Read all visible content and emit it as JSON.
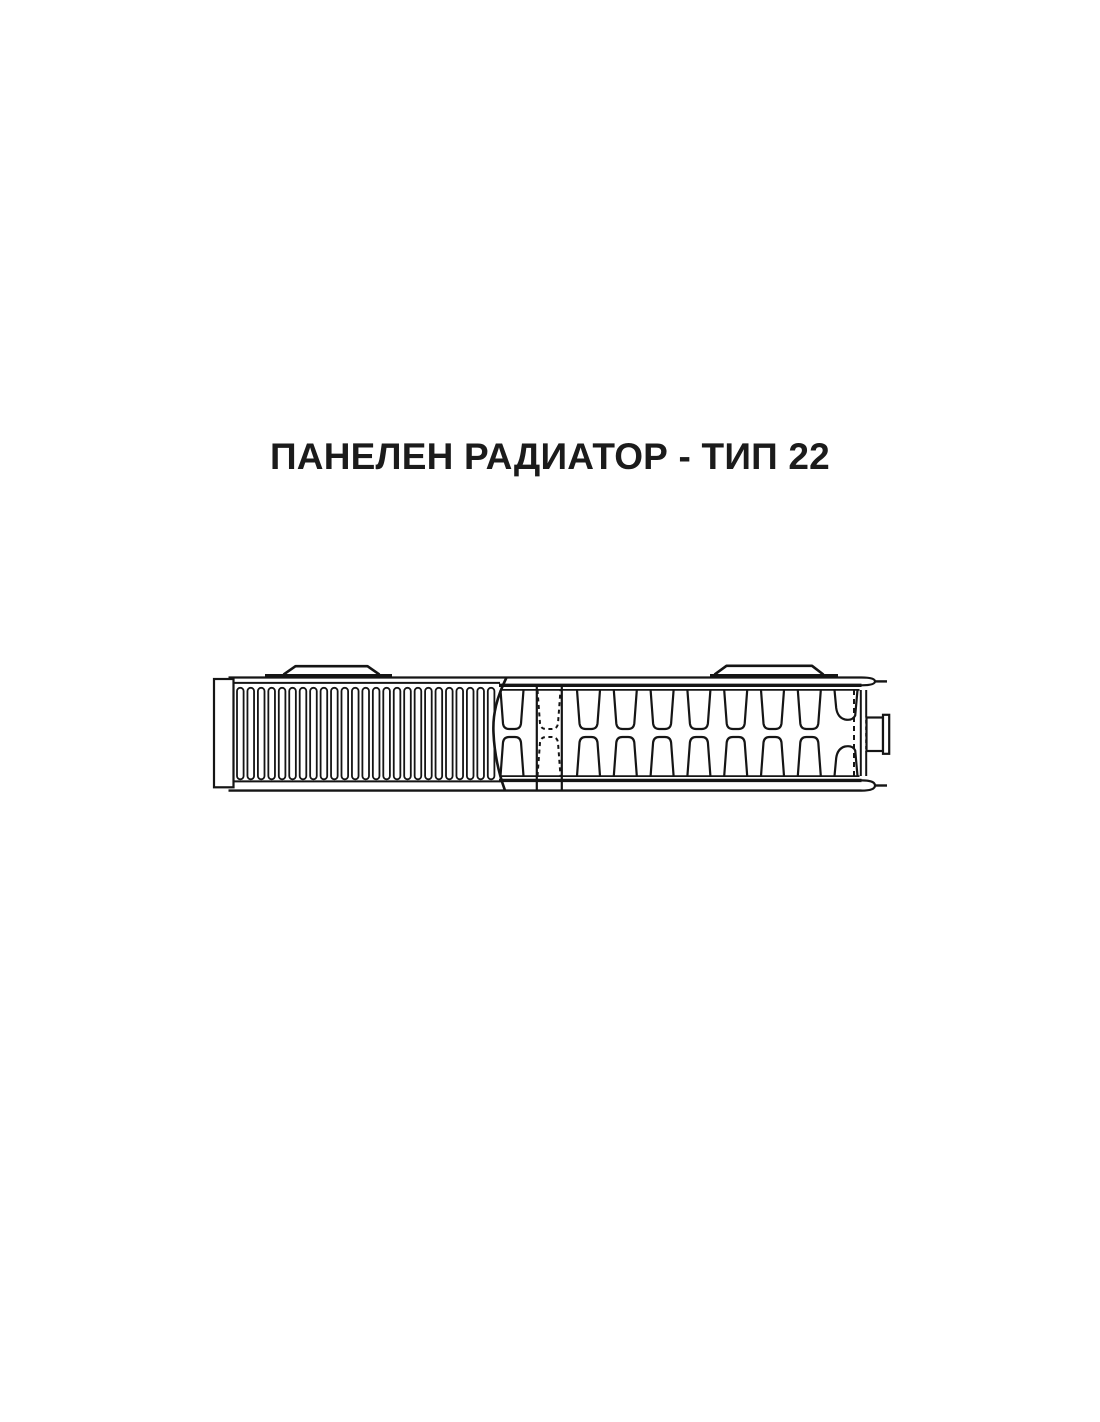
{
  "page": {
    "background": "#ffffff"
  },
  "title": {
    "text": "ПАНЕЛЕН РАДИАТОР - ТИП 22",
    "color": "#1b1b1b"
  },
  "diagram": {
    "name": "panel-radiator-type-22-section-view",
    "description": "technical line drawing of a type 22 panel radiator, partial front view with convector fins on the left and a horizontal cut section with water channels on the right",
    "line_color": "#151515",
    "fill_color": "#ffffff",
    "fins": {
      "count": 25,
      "start_x": 237,
      "pitch": 10.45,
      "width": 6.6,
      "top_y": 687.8,
      "height": 91.5,
      "corner_radius": 3.3
    },
    "channels": {
      "solid_centers": [
        512,
        588.5,
        625.3,
        662.1,
        698.9,
        735.7,
        772.5,
        809.3
      ],
      "dashed_center": 549,
      "break_center": 846,
      "top_attach_y": 690,
      "top_end_y": 729,
      "bottom_attach_y": 776,
      "bottom_end_y": 737,
      "half_width_top": 11.5
    },
    "parts": {
      "left_end_cap": "left end cap",
      "mounting_bracket_left": "upper mounting bracket (left)",
      "mounting_bracket_right": "upper mounting bracket (right)",
      "hidden_channel": "hidden channel shown dashed",
      "connection_boss": "side connection boss with flange",
      "break_lines": "section break curves"
    }
  }
}
